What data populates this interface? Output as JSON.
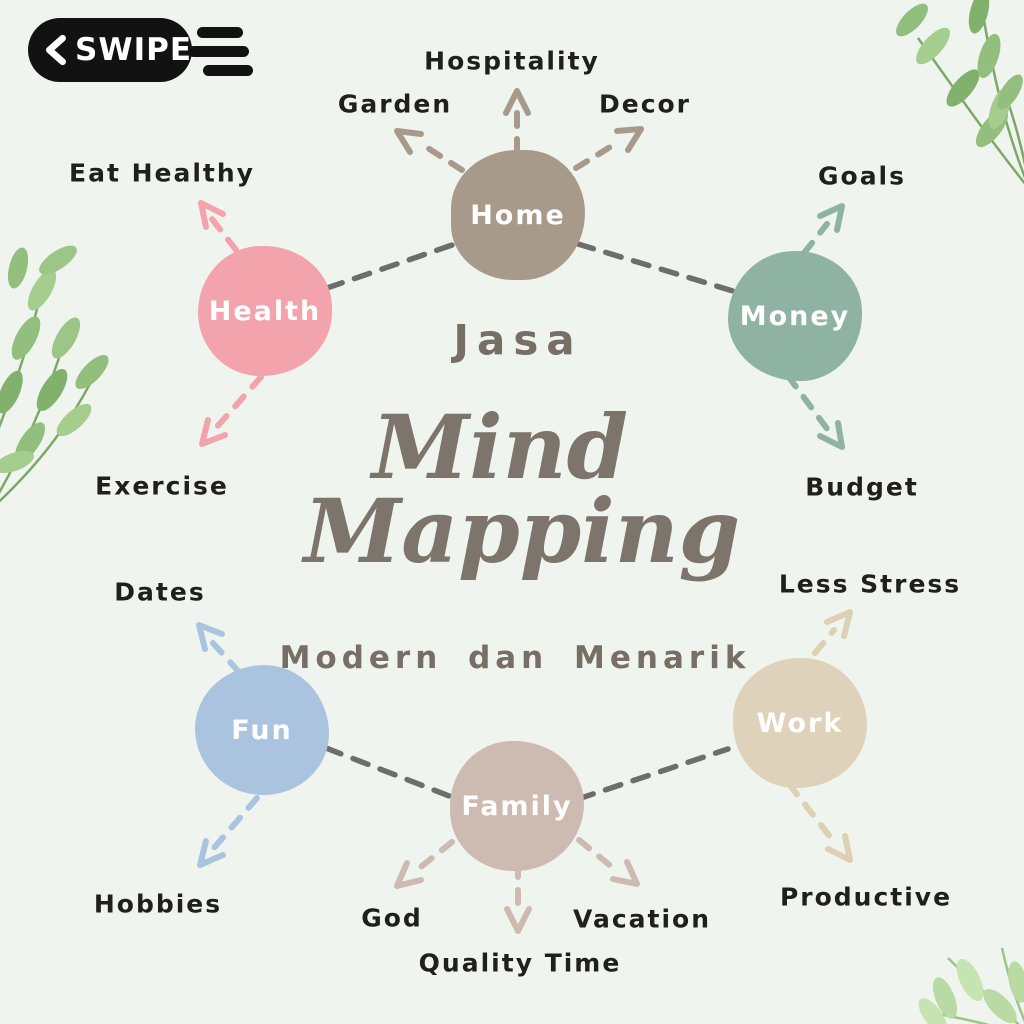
{
  "badge": {
    "label": "SWIPE",
    "icon": "chevron-left",
    "bg_color": "#121212",
    "text_color": "#ffffff"
  },
  "title": {
    "kicker": "Jasa",
    "script_line1": "Mind",
    "script_line2": "Mapping",
    "subtitle": "Modern dan Menarik",
    "text_color": "#7d746b"
  },
  "background_color": "#eff5ee",
  "connector_color": "#6d6d6d",
  "label_color": "#211f1d",
  "nodes": {
    "home": {
      "label": "Home",
      "color": "#a79a8b",
      "branches": [
        "Garden",
        "Hospitality",
        "Decor"
      ]
    },
    "health": {
      "label": "Health",
      "color": "#f2a3ab",
      "branches": [
        "Eat Healthy",
        "Exercise"
      ]
    },
    "money": {
      "label": "Money",
      "color": "#8fb3a3",
      "branches": [
        "Goals",
        "Budget"
      ]
    },
    "fun": {
      "label": "Fun",
      "color": "#aac4df",
      "branches": [
        "Dates",
        "Hobbies"
      ]
    },
    "family": {
      "label": "Family",
      "color": "#cdbab1",
      "branches": [
        "God",
        "Quality Time",
        "Vacation"
      ]
    },
    "work": {
      "label": "Work",
      "color": "#ded2ba",
      "branches": [
        "Less Stress",
        "Productive"
      ]
    }
  },
  "connections": [
    [
      "health",
      "home"
    ],
    [
      "home",
      "money"
    ],
    [
      "fun",
      "family"
    ],
    [
      "family",
      "work"
    ]
  ],
  "satellites": {
    "garden": "Garden",
    "hospitality": "Hospitality",
    "decor": "Decor",
    "eat_healthy": "Eat Healthy",
    "goals": "Goals",
    "exercise": "Exercise",
    "budget": "Budget",
    "dates": "Dates",
    "less_stress": "Less Stress",
    "hobbies": "Hobbies",
    "god": "God",
    "quality_time": "Quality Time",
    "vacation": "Vacation",
    "productive": "Productive"
  },
  "decorations": {
    "leaves_green": "#92bf7d",
    "leaves_light_green": "#b9dba3"
  }
}
